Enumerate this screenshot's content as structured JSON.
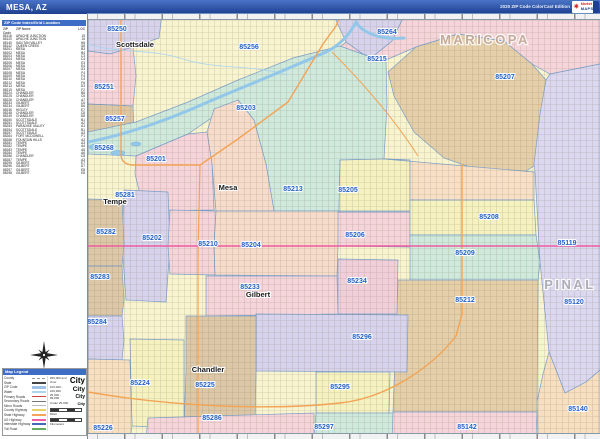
{
  "header": {
    "title": "MESA, AZ",
    "edition": "2020 ZIP Code ColorCast Edition",
    "logo": {
      "star": "✷",
      "line1": "Market",
      "line2": "MAPS"
    }
  },
  "sidebar": {
    "table": {
      "title": "ZIP Code Index/Grid Location",
      "columns": [
        "ZIP Code",
        "ZIP Name",
        "LOC"
      ],
      "rows": [
        [
          "85118",
          "APACHE JUNCTION",
          "J5"
        ],
        [
          "85120",
          "APACHE JUNCTION",
          "J6"
        ],
        [
          "85140",
          "SAN TAN VALLEY",
          "H8"
        ],
        [
          "85142",
          "QUEEN CREEK",
          "G8"
        ],
        [
          "85201",
          "MESA",
          "B3"
        ],
        [
          "85202",
          "MESA",
          "B4"
        ],
        [
          "85203",
          "MESA",
          "C3"
        ],
        [
          "85204",
          "MESA",
          "C4"
        ],
        [
          "85205",
          "MESA",
          "E3"
        ],
        [
          "85206",
          "MESA",
          "E4"
        ],
        [
          "85207",
          "MESA",
          "G3"
        ],
        [
          "85208",
          "MESA",
          "F4"
        ],
        [
          "85209",
          "MESA",
          "F4"
        ],
        [
          "85210",
          "MESA",
          "C4"
        ],
        [
          "85212",
          "MESA",
          "F6"
        ],
        [
          "85213",
          "MESA",
          "D3"
        ],
        [
          "85215",
          "MESA",
          "F2"
        ],
        [
          "85224",
          "CHANDLER",
          "B6"
        ],
        [
          "85225",
          "CHANDLER",
          "C6"
        ],
        [
          "85226",
          "CHANDLER",
          "A7"
        ],
        [
          "85233",
          "GILBERT",
          "C6"
        ],
        [
          "85234",
          "GILBERT",
          "D6"
        ],
        [
          "85236",
          "HIGLEY",
          "E7"
        ],
        [
          "85248",
          "CHANDLER",
          "C8"
        ],
        [
          "85249",
          "CHANDLER",
          "D8"
        ],
        [
          "85250",
          "SCOTTSDALE",
          "B1"
        ],
        [
          "85251",
          "SCOTTSDALE",
          "A2"
        ],
        [
          "85253",
          "PARADISE VALLEY",
          "A1"
        ],
        [
          "85254",
          "SCOTTSDALE",
          "B1"
        ],
        [
          "85257",
          "SCOTTSDALE",
          "A3"
        ],
        [
          "85264",
          "FORT MCDOWELL",
          "F1"
        ],
        [
          "85268",
          "FOUNTAIN HILLS",
          "A3"
        ],
        [
          "85281",
          "TEMPE",
          "A3"
        ],
        [
          "85282",
          "TEMPE",
          "A4"
        ],
        [
          "85283",
          "TEMPE",
          "A5"
        ],
        [
          "85284",
          "TEMPE",
          "A6"
        ],
        [
          "85286",
          "CHANDLER",
          "C8"
        ],
        [
          "85287",
          "TEMPE",
          "A3"
        ],
        [
          "85295",
          "GILBERT",
          "E7"
        ],
        [
          "85296",
          "GILBERT",
          "D7"
        ],
        [
          "85297",
          "GILBERT",
          "E8"
        ],
        [
          "85298",
          "GILBERT",
          "E8"
        ]
      ]
    },
    "legend": {
      "title": "Map Legend",
      "lines": [
        {
          "label": "County",
          "color": "#999999",
          "dash": true,
          "h": 1
        },
        {
          "label": "State",
          "color": "#444444",
          "dash": false,
          "h": 1.5
        },
        {
          "label": "ZIP Code",
          "color": "#9fc3e8",
          "dash": false,
          "h": 2.5
        },
        {
          "label": "Water",
          "color": "#aad4f0",
          "dash": false,
          "h": 2.5
        },
        {
          "label": "Primary Roads",
          "color": "#cc4444",
          "dash": false,
          "h": 1.5
        },
        {
          "label": "Secondary Roads",
          "color": "#777777",
          "dash": false,
          "h": 1
        },
        {
          "label": "Minor Roads",
          "color": "#bbbbbb",
          "dash": false,
          "h": 1
        },
        {
          "label": "County Highway",
          "color": "#e8d06a",
          "dash": false,
          "h": 2
        },
        {
          "label": "State Highway",
          "color": "#f4a259",
          "dash": false,
          "h": 2
        },
        {
          "label": "US Highway",
          "color": "#ef5ba1",
          "dash": false,
          "h": 2
        },
        {
          "label": "Interstate Highway",
          "color": "#4466bb",
          "dash": false,
          "h": 2
        },
        {
          "label": "Toll Road",
          "color": "#66aa66",
          "dash": false,
          "h": 2
        }
      ],
      "city_sizes_sample": "City",
      "city_sizes": [
        {
          "caption": "250,000 and Over",
          "px": 8
        },
        {
          "caption": "100,000 - 249,999",
          "px": 6.5
        },
        {
          "caption": "25,000 - 99,999",
          "px": 5
        },
        {
          "caption": "Under 25,000",
          "px": 4
        }
      ],
      "scales": [
        {
          "label": "Miles"
        },
        {
          "label": "Kilometers"
        }
      ]
    }
  },
  "map": {
    "palette": {
      "base": "#f8f4cf",
      "lavender": "#d8d3ec",
      "lavender2": "#dcd8ef",
      "pink": "#f5d4da",
      "pink2": "#f1cfda",
      "peach": "#f7dfc0",
      "peach2": "#f8e0c6",
      "peach3": "#f7dccb",
      "tan": "#dcc8a6",
      "tan2": "#e5cfa9",
      "yellow": "#f6f2c0",
      "mint": "#cfeadd",
      "border": "#7b9fca",
      "water": "#92c7e9",
      "highway_orange": "#f2a355",
      "highway_pink": "#ee5ba0"
    },
    "base_region": "85256",
    "regions": [
      {
        "id": "85250",
        "fill": "lavender",
        "points": "0,0 74,0 71,24 45,33 22,40 0,37"
      },
      {
        "id": "85264",
        "fill": "lavender",
        "points": "246,2 248,0 317,0 304,27 282,45 258,28"
      },
      {
        "id": "85215",
        "fill": "pink",
        "points": "252,33 258,28 282,45 304,27 317,0 512,0 512,50 462,60 444,50 416,27 370,20 328,33 298,46 274,40"
      },
      {
        "id": "85207",
        "fill": "tan2",
        "points": "328,33 370,20 416,27 444,50 458,66 461,120 446,152 428,163 396,158 356,144 326,118 306,82 300,58"
      },
      {
        "id": "85119",
        "fill": "lavender2",
        "points": "512,50 512,356 498,368 477,379 461,338 452,248 447,158 446,150 452,100 458,66 462,60"
      },
      {
        "id": "85140",
        "fill": "peach",
        "points": "512,356 512,425 450,425 449,388 455,360 461,338 477,379 498,368"
      },
      {
        "id": "85251",
        "fill": "pink",
        "points": "0,37 22,40 45,33 48,62 45,92 0,90"
      },
      {
        "id": "85257",
        "fill": "tan",
        "points": "0,90 45,92 46,118 38,128 0,124"
      },
      {
        "id": "85213",
        "fill": "mint",
        "points": "0,118 48,108 100,88 150,66 205,44 252,32 274,40 298,48 299,90 296,145 252,146 251,197 186,197 178,150 166,106 150,86 100,120 48,142 0,140"
      },
      {
        "id": "85205",
        "fill": "yellow",
        "points": "252,146 296,145 322,146 322,197 251,197"
      },
      {
        "id": "85215s",
        "fill": "peach2",
        "points": "296,145 446,158 446,186 322,186 322,146"
      },
      {
        "id": "85203",
        "fill": "peach3",
        "points": "150,86 166,106 178,150 186,197 128,197 124,150 119,118 126,95"
      },
      {
        "id": "85201",
        "fill": "pink",
        "points": "48,142 100,120 119,118 124,150 126,196 56,197 47,160"
      },
      {
        "id": "85202",
        "fill": "lavender",
        "points": "36,176 80,178 82,232 78,288 38,286 34,230"
      },
      {
        "id": "85282",
        "fill": "tan",
        "points": "0,185 34,186 36,230 34,252 0,252"
      },
      {
        "id": "85283",
        "fill": "tan",
        "points": "0,252 34,252 36,286 34,302 0,302"
      },
      {
        "id": "85284",
        "fill": "lavender",
        "points": "0,302 34,302 36,326 34,346 0,345"
      },
      {
        "id": "85210",
        "fill": "pink",
        "points": "82,196 128,197 126,232 127,261 82,260 80,232"
      },
      {
        "id": "85204",
        "fill": "peach3",
        "points": "128,197 251,197 250,232 249,262 127,261 126,232"
      },
      {
        "id": "85206",
        "fill": "pink",
        "points": "250,198 322,198 322,233 250,232"
      },
      {
        "id": "85208",
        "fill": "yellow",
        "points": "322,186 446,186 448,221 322,221"
      },
      {
        "id": "85209",
        "fill": "mint",
        "points": "322,221 448,221 452,248 450,266 322,266"
      },
      {
        "id": "85212",
        "fill": "tan2",
        "points": "310,266 450,266 449,398 305,398"
      },
      {
        "id": "85234",
        "fill": "pink2",
        "points": "250,245 310,246 309,300 250,300"
      },
      {
        "id": "85233",
        "fill": "pink",
        "points": "118,262 249,262 250,300 118,302"
      },
      {
        "id": "85296",
        "fill": "lavender",
        "points": "168,300 320,301 319,358 168,357"
      },
      {
        "id": "85225",
        "fill": "tan",
        "points": "98,302 168,302 168,357 167,415 96,414 98,357"
      },
      {
        "id": "85224",
        "fill": "yellow",
        "points": "42,325 96,326 96,414 44,412"
      },
      {
        "id": "85226",
        "fill": "peach",
        "points": "0,345 42,346 44,412 42,425 0,425"
      },
      {
        "id": "85295",
        "fill": "yellow",
        "points": "228,358 302,358 301,400 228,399"
      },
      {
        "id": "85286",
        "fill": "pink",
        "points": "60,404 226,399 226,425 58,425"
      },
      {
        "id": "85297",
        "fill": "mint",
        "points": "228,399 308,399 307,425 226,425"
      },
      {
        "id": "85142",
        "fill": "pink",
        "points": "305,398 449,398 448,425 304,425"
      }
    ],
    "river": {
      "name": "salt-river",
      "d": "M0,128 C40,120 80,106 120,88 C160,71 200,55 238,38 C252,31 262,20 268,8 C274,18 290,26 316,24",
      "w": 3
    },
    "canal": {
      "name": "canal",
      "d": "M0,30 C30,40 62,34 95,45 C130,56 162,50 200,61",
      "w": 0.8
    },
    "lakes": [
      {
        "cx": 10,
        "cy": 133,
        "rx": 9,
        "ry": 3.2
      },
      {
        "cx": 30,
        "cy": 139,
        "rx": 7,
        "ry": 2.6
      },
      {
        "cx": 48,
        "cy": 130,
        "rx": 5,
        "ry": 2
      }
    ],
    "roads": [
      {
        "name": "loop-101",
        "d": "M33,0 L33,140 Q33,150 44,151 L112,151",
        "color": "highway_orange",
        "w": 1.4
      },
      {
        "name": "az-87-beeline",
        "d": "M112,151 L150,125 L200,88 L235,30 L248,12 L253,0",
        "color": "highway_orange",
        "w": 1.4
      },
      {
        "name": "country-club-dr",
        "d": "M112,151 L110,240 L110,425",
        "color": "highway_orange",
        "w": 1.2
      },
      {
        "name": "bush-hwy",
        "d": "M244,38 Q298,92 330,142",
        "color": "highway_orange",
        "w": 1
      },
      {
        "name": "loop-202-santan",
        "d": "M0,378 C80,392 180,397 252,389 C300,384 345,352 368,322 L374,300 L374,150",
        "color": "highway_orange",
        "w": 1.4
      },
      {
        "name": "us-60",
        "d": "M0,232 L512,232",
        "color": "highway_pink",
        "w": 1.6
      }
    ],
    "zip_labels": [
      {
        "z": "85250",
        "x": 29,
        "y": 17
      },
      {
        "z": "85256",
        "x": 161,
        "y": 35
      },
      {
        "z": "85264",
        "x": 299,
        "y": 20
      },
      {
        "z": "85215",
        "x": 289,
        "y": 47
      },
      {
        "z": "85207",
        "x": 417,
        "y": 65
      },
      {
        "z": "85251",
        "x": 16,
        "y": 75
      },
      {
        "z": "85203",
        "x": 158,
        "y": 96
      },
      {
        "z": "85257",
        "x": 27,
        "y": 107
      },
      {
        "z": "85268",
        "x": 16,
        "y": 136
      },
      {
        "z": "85201",
        "x": 68,
        "y": 147
      },
      {
        "z": "85213",
        "x": 205,
        "y": 177
      },
      {
        "z": "85205",
        "x": 260,
        "y": 178
      },
      {
        "z": "85281",
        "x": 37,
        "y": 183
      },
      {
        "z": "85282",
        "x": 18,
        "y": 220
      },
      {
        "z": "85202",
        "x": 64,
        "y": 226
      },
      {
        "z": "85210",
        "x": 120,
        "y": 232
      },
      {
        "z": "85204",
        "x": 163,
        "y": 233
      },
      {
        "z": "85206",
        "x": 267,
        "y": 223
      },
      {
        "z": "85208",
        "x": 401,
        "y": 205
      },
      {
        "z": "85209",
        "x": 377,
        "y": 241
      },
      {
        "z": "85283",
        "x": 12,
        "y": 265
      },
      {
        "z": "85233",
        "x": 162,
        "y": 275
      },
      {
        "z": "85234",
        "x": 269,
        "y": 269
      },
      {
        "z": "85119",
        "x": 479,
        "y": 231
      },
      {
        "z": "85212",
        "x": 377,
        "y": 288
      },
      {
        "z": "85120",
        "x": 486,
        "y": 290
      },
      {
        "z": "85284",
        "x": 9,
        "y": 310
      },
      {
        "z": "85296",
        "x": 274,
        "y": 325
      },
      {
        "z": "85224",
        "x": 52,
        "y": 371
      },
      {
        "z": "85225",
        "x": 117,
        "y": 373
      },
      {
        "z": "85295",
        "x": 252,
        "y": 375
      },
      {
        "z": "85286",
        "x": 124,
        "y": 406
      },
      {
        "z": "85226",
        "x": 15,
        "y": 416
      },
      {
        "z": "85297",
        "x": 236,
        "y": 415
      },
      {
        "z": "85142",
        "x": 379,
        "y": 415
      },
      {
        "z": "85140",
        "x": 490,
        "y": 397
      }
    ],
    "city_labels": [
      {
        "n": "Scottsdale",
        "x": 47,
        "y": 33
      },
      {
        "n": "Mesa",
        "x": 140,
        "y": 176
      },
      {
        "n": "Tempe",
        "x": 27,
        "y": 190
      },
      {
        "n": "Gilbert",
        "x": 170,
        "y": 283
      },
      {
        "n": "Chandler",
        "x": 120,
        "y": 358
      }
    ],
    "county_labels": [
      {
        "n": "MARICOPA",
        "x": 397,
        "y": 30,
        "color": "#c2a594"
      },
      {
        "n": "PINAL",
        "x": 482,
        "y": 275,
        "color": "#a7a7b0"
      }
    ]
  }
}
